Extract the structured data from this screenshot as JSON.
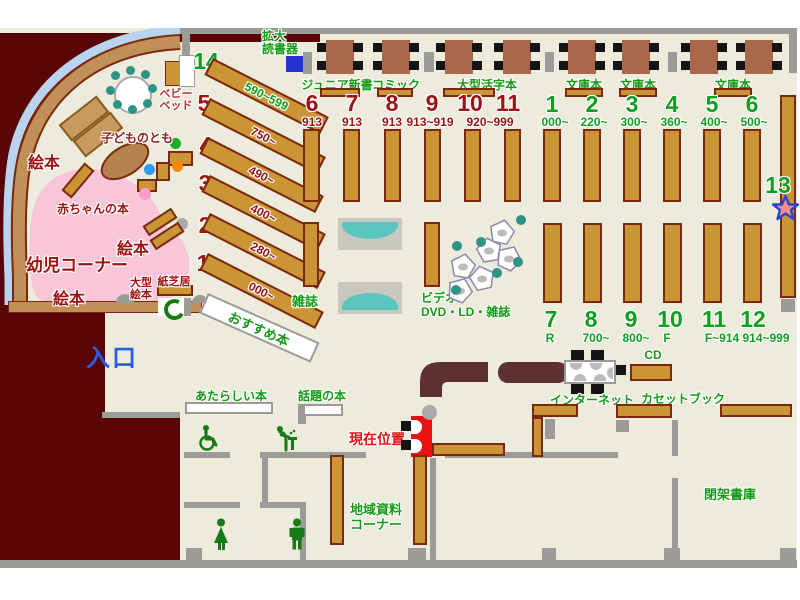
{
  "entrance_label": "入口",
  "kids": {
    "corner": "幼児コーナー",
    "baby_books": "赤ちゃんの本",
    "picture_books": "絵本",
    "kodomonotomo": "子どものとも",
    "baby_bed_line1": "ベビー",
    "baby_bed_line2": "ベッド",
    "large_picture_line1": "大型",
    "large_picture_line2": "絵本",
    "kamishibai": "紙芝居"
  },
  "services": {
    "magnifier_line1": "拡大",
    "magnifier_line2": "読書器",
    "current_location": "現在位置",
    "internet": "インターネット",
    "cd": "CD",
    "cassette_books": "カセットブック",
    "closed_stacks": "閉架書庫",
    "local_materials_line1": "地域資料",
    "local_materials_line2": "コーナー"
  },
  "displays": {
    "recommended": "おすすめ本",
    "new_books": "あたらしい本",
    "topic_books": "話題の本",
    "magazines": "雑誌",
    "video_line1": "ビデオ・",
    "video_line2": "DVD・LD・雑誌"
  },
  "genres": {
    "junior": "ジュニア新書",
    "comic": "コミック",
    "large_print": "大型活字本",
    "bunko": "文庫本"
  },
  "fan_shelves": [
    {
      "no": "14",
      "range": "590~599"
    },
    {
      "no": "5",
      "range": "750~"
    },
    {
      "no": "4",
      "range": "490~"
    },
    {
      "no": "3",
      "range": "400~"
    },
    {
      "no": "2",
      "range": "280~"
    },
    {
      "no": "1",
      "range": "000~"
    }
  ],
  "red_sections": [
    {
      "no": "6",
      "val": "913"
    },
    {
      "no": "7",
      "val": "913"
    },
    {
      "no": "8",
      "val": "913"
    },
    {
      "no": "9",
      "val": "913~919"
    },
    {
      "no": "10",
      "val": ""
    },
    {
      "no": "11",
      "val": ""
    }
  ],
  "red_shared_val": "920~999",
  "green_top_sections": [
    {
      "no": "1",
      "val": "000~"
    },
    {
      "no": "2",
      "val": "220~"
    },
    {
      "no": "3",
      "val": "300~"
    },
    {
      "no": "4",
      "val": "360~"
    },
    {
      "no": "5",
      "val": "400~"
    },
    {
      "no": "6",
      "val": "500~"
    }
  ],
  "green_bottom_sections": [
    {
      "no": "7",
      "val": "R"
    },
    {
      "no": "8",
      "val": "700~"
    },
    {
      "no": "9",
      "val": "800~"
    },
    {
      "no": "10",
      "val": "F"
    },
    {
      "no": "11",
      "val": "F~914"
    },
    {
      "no": "12",
      "val": "914~999"
    }
  ],
  "section_13": "13",
  "icons": {
    "section13_marker": "star",
    "current_location_marker": "red-you-are-here-panel",
    "phone": "public-phone-c",
    "toilets": [
      "wheelchair",
      "baby-changing",
      "woman",
      "man"
    ],
    "magnifier_device": "blue-square-reader"
  },
  "colors": {
    "floor": "#edebdb",
    "outside": "#5a0505",
    "wall": "#9b9b97",
    "shelf": "#cb9434",
    "shelf_border": "#7c2810",
    "kids_pink": "#f8c5d9",
    "green_text": "#149a14",
    "dark_red_text": "#9c1111",
    "entrance_blue": "#2b5ce6",
    "marker_red": "#ea1111",
    "counter": "#5d3132",
    "bench_teal": "#5cc6be",
    "chair_teal": "#2e9387",
    "table_brown": "#a9684a",
    "star_fill": "#f58d8d",
    "star_stroke": "#2b46cc"
  }
}
